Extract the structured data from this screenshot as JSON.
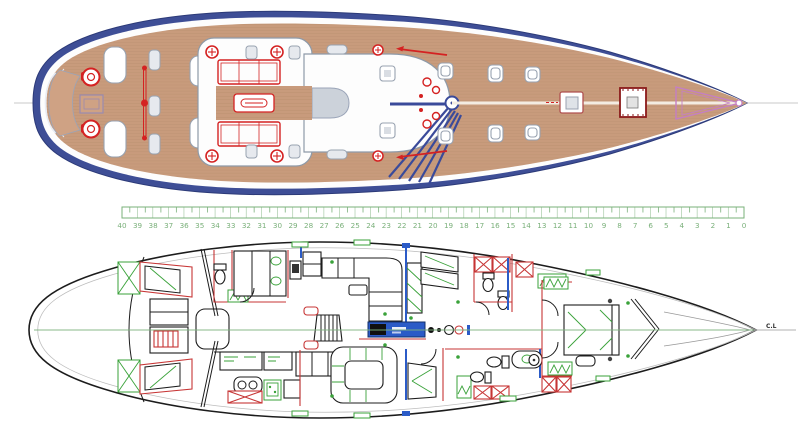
{
  "ruler": {
    "labels": [
      "40",
      "39",
      "38",
      "37",
      "36",
      "35",
      "34",
      "33",
      "32",
      "31",
      "30",
      "29",
      "28",
      "27",
      "26",
      "25",
      "24",
      "23",
      "22",
      "21",
      "20",
      "19",
      "18",
      "17",
      "16",
      "15",
      "14",
      "13",
      "12",
      "11",
      "10",
      "9",
      "8",
      "7",
      "6",
      "5",
      "4",
      "3",
      "2",
      "1",
      "0"
    ]
  },
  "labels": {
    "centerline": "C.L"
  },
  "colors": {
    "hull_blue": "#3e4e96",
    "hull_outline": "#2c3a78",
    "deck_white": "#fdfdfd",
    "teak": "#c89b7c",
    "plank_line": "#b48a68",
    "fitting_red": "#d42222",
    "windlass_darkred": "#8b1a1a",
    "anchor_pink": "#c47ec4",
    "rigging_blue": "#3a4a9a",
    "ruler_green": "#7ab07a",
    "interior_green": "#3aa23a",
    "wall_red": "#c73535",
    "accent_blue": "#2b5bc7",
    "outline_black": "#1c1c1c"
  }
}
